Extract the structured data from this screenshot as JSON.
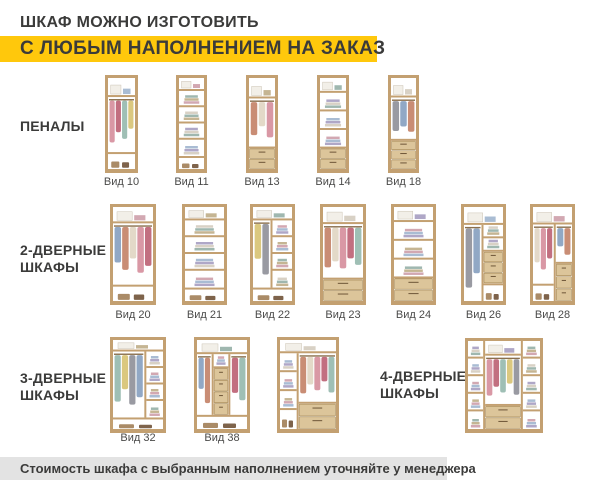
{
  "header": {
    "line1": "ШКАФ МОЖНО ИЗГОТОВИТЬ",
    "line2": "С ЛЮБЫМ НАПОЛНЕНИЕМ НА ЗАКАЗ"
  },
  "footer": {
    "note": "Стоимость шкафа с выбранным наполнением уточняйте у менеджера"
  },
  "colors": {
    "background": "#FFFFFF",
    "accent_yellow": "#FFC80C",
    "footer_gray": "#E3E3E3",
    "text_dark": "#3B3B3A",
    "label_gray": "#4A4A49",
    "wood": "#C3A071",
    "wood_dark": "#8A6F4D",
    "drawer_face": "#DCC59A",
    "drawer_edge": "#A78A58",
    "interior": "#FFFFFF"
  },
  "palette": {
    "clothes": [
      "#D998A5",
      "#C26F80",
      "#9FBFB5",
      "#DBC87F",
      "#999AA2",
      "#91A8C5",
      "#C98D75",
      "#E3D9C8"
    ],
    "folded": [
      "#A9BCD3",
      "#D2A8B2",
      "#C5B593",
      "#9FB7AF",
      "#D8D1C5",
      "#AFA7C7"
    ]
  },
  "groups": [
    {
      "label": "ПЕНАЛЫ",
      "items": [
        {
          "label": "Вид 10",
          "cfg": {
            "t": 0.9,
            "b": 0.8,
            "cols": [
              {
                "f": 1,
                "s": [
                  [
                    "hang",
                    2.6
                  ]
                ]
              }
            ]
          }
        },
        {
          "label": "Вид 11",
          "cfg": {
            "t": 0.8,
            "b": 0.8,
            "cols": [
              {
                "f": 1,
                "s": [
                  [
                    "shelf",
                    1
                  ],
                  [
                    "shelf",
                    1
                  ],
                  [
                    "shelf",
                    1
                  ],
                  [
                    "shelf",
                    1
                  ]
                ]
              }
            ]
          }
        },
        {
          "label": "Вид 13",
          "cfg": {
            "t": 0.9,
            "cols": [
              {
                "f": 1,
                "s": [
                  [
                    "hang",
                    2.2
                  ],
                  [
                    "drawers2",
                    0.9
                  ]
                ]
              }
            ]
          }
        },
        {
          "label": "Вид 14",
          "cfg": {
            "t": 0.8,
            "cols": [
              {
                "f": 1,
                "s": [
                  [
                    "shelf",
                    1
                  ],
                  [
                    "shelf",
                    1
                  ],
                  [
                    "shelf",
                    1
                  ],
                  [
                    "drawers2",
                    1.1
                  ]
                ]
              }
            ]
          }
        },
        {
          "label": "Вид 18",
          "cfg": {
            "t": 0.9,
            "cols": [
              {
                "f": 1,
                "s": [
                  [
                    "hang",
                    2.0
                  ],
                  [
                    "drawers3",
                    1.3
                  ]
                ]
              }
            ]
          }
        }
      ]
    },
    {
      "label": "2-ДВЕРНЫЕ ШКАФЫ",
      "items": [
        {
          "label": "Вид 20",
          "cfg": {
            "t": 0.8,
            "b": 0.8,
            "cols": [
              {
                "f": 1,
                "s": [
                  [
                    "hang",
                    3
                  ]
                ]
              }
            ]
          }
        },
        {
          "label": "Вид 21",
          "cfg": {
            "t": 0.8,
            "b": 0.8,
            "cols": [
              {
                "f": 1,
                "s": [
                  [
                    "shelf",
                    1
                  ],
                  [
                    "shelf",
                    1
                  ],
                  [
                    "shelf",
                    1
                  ],
                  [
                    "shelf",
                    1
                  ]
                ]
              }
            ]
          }
        },
        {
          "label": "Вид 22",
          "cfg": {
            "t": 0.8,
            "b": 0.8,
            "cols": [
              {
                "f": 1,
                "s": [
                  [
                    "hang",
                    3
                  ]
                ]
              },
              {
                "f": 1,
                "s": [
                  [
                    "shelf",
                    1
                  ],
                  [
                    "shelf",
                    1
                  ],
                  [
                    "shelf",
                    1
                  ],
                  [
                    "shelf",
                    1
                  ]
                ]
              }
            ]
          }
        },
        {
          "label": "Вид 23",
          "cfg": {
            "t": 0.8,
            "cols": [
              {
                "f": 1,
                "s": [
                  [
                    "hang",
                    2.6
                  ],
                  [
                    "drawers2",
                    1.0
                  ]
                ]
              }
            ]
          }
        },
        {
          "label": "Вид 24",
          "cfg": {
            "t": 0.8,
            "cols": [
              {
                "f": 1,
                "s": [
                  [
                    "shelf",
                    1
                  ],
                  [
                    "shelf",
                    1
                  ],
                  [
                    "shelf",
                    1
                  ],
                  [
                    "drawers2",
                    1.2
                  ]
                ]
              }
            ]
          }
        },
        {
          "label": "Вид 26",
          "cfg": {
            "t": 0.8,
            "cols": [
              {
                "f": 1,
                "s": [
                  [
                    "hang",
                    3.4
                  ]
                ]
              },
              {
                "f": 1,
                "s": [
                  [
                    "shelf",
                    0.6
                  ],
                  [
                    "shelf",
                    0.6
                  ],
                  [
                    "drawers3",
                    1.5
                  ],
                  [
                    "base",
                    0.7
                  ]
                ]
              }
            ]
          }
        },
        {
          "label": "Вид 28",
          "cfg": {
            "t": 0.8,
            "cols": [
              {
                "f": 1.4,
                "s": [
                  [
                    "hang",
                    2.8
                  ],
                  [
                    "base",
                    0.7
                  ]
                ]
              },
              {
                "f": 1,
                "s": [
                  [
                    "hang",
                    1.8
                  ],
                  [
                    "drawers3",
                    1.7
                  ]
                ]
              }
            ]
          }
        }
      ]
    },
    {
      "label": "3-ДВЕРНЫЕ ШКАФЫ",
      "items": [
        {
          "label": "Вид 32",
          "cfg": {
            "t": 0.7,
            "b": 0.7,
            "cols": [
              {
                "f": 2,
                "s": [
                  [
                    "hang",
                    3
                  ]
                ]
              },
              {
                "f": 1,
                "s": [
                  [
                    "shelf",
                    1
                  ],
                  [
                    "shelf",
                    1
                  ],
                  [
                    "shelf",
                    1
                  ],
                  [
                    "shelf",
                    1
                  ]
                ]
              }
            ]
          }
        },
        {
          "label": "Вид 38",
          "cfg": {
            "t": 0.7,
            "b": 0.7,
            "cols": [
              {
                "f": 1,
                "s": [
                  [
                    "hang",
                    3
                  ]
                ]
              },
              {
                "f": 1,
                "s": [
                  [
                    "shelf",
                    0.7
                  ],
                  [
                    "drawers4",
                    2.3
                  ]
                ]
              },
              {
                "f": 1,
                "s": [
                  [
                    "hang",
                    3
                  ]
                ]
              }
            ]
          }
        },
        {
          "label": "",
          "cfg": {
            "t": 0.7,
            "cols": [
              {
                "f": 1,
                "s": [
                  [
                    "shelf",
                    1
                  ],
                  [
                    "shelf",
                    1
                  ],
                  [
                    "shelf",
                    1
                  ],
                  [
                    "base",
                    1
                  ]
                ]
              },
              {
                "f": 2,
                "s": [
                  [
                    "hang",
                    2.4
                  ],
                  [
                    "drawers2",
                    1.2
                  ]
                ]
              }
            ]
          }
        }
      ]
    },
    {
      "label": "4-ДВЕРНЫЕ ШКАФЫ",
      "items": [
        {
          "label": "",
          "cfg": {
            "cols": [
              {
                "f": 1,
                "s": [
                  [
                    "shelf",
                    1
                  ],
                  [
                    "shelf",
                    1
                  ],
                  [
                    "shelf",
                    1
                  ],
                  [
                    "shelf",
                    1
                  ],
                  [
                    "shelf",
                    1
                  ]
                ]
              },
              {
                "f": 2.2,
                "s": [
                  [
                    "top",
                    0.7
                  ],
                  [
                    "hang",
                    2.4
                  ],
                  [
                    "drawers2",
                    1.1
                  ]
                ]
              },
              {
                "f": 1,
                "s": [
                  [
                    "shelf",
                    1
                  ],
                  [
                    "shelf",
                    1
                  ],
                  [
                    "shelf",
                    1
                  ],
                  [
                    "shelf",
                    1
                  ],
                  [
                    "shelf",
                    1
                  ]
                ]
              }
            ]
          }
        }
      ]
    }
  ]
}
